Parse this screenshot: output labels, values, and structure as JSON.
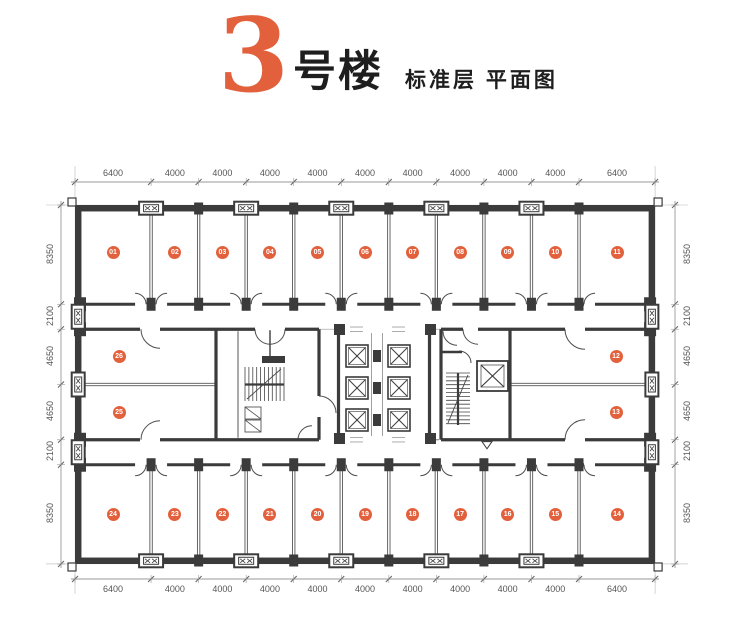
{
  "title": {
    "building_number": "3",
    "building_suffix": "号楼",
    "subtitle": "标准层 平面图"
  },
  "colors": {
    "accent": "#E2603C",
    "wall": "#3B3B3B",
    "dim_text": "#555555"
  },
  "plan": {
    "dimensions_mm": {
      "top": [
        "6400",
        "4000",
        "4000",
        "4000",
        "4000",
        "4000",
        "4000",
        "4000",
        "4000",
        "4000",
        "6400"
      ],
      "bottom": [
        "6400",
        "4000",
        "4000",
        "4000",
        "4000",
        "4000",
        "4000",
        "4000",
        "4000",
        "4000",
        "6400"
      ],
      "left": [
        "8350",
        "2100",
        "4650",
        "4650",
        "2100",
        "8350"
      ],
      "right": [
        "8350",
        "2100",
        "4650",
        "4650",
        "2100",
        "8350"
      ]
    },
    "rooms": {
      "top_row": [
        "01",
        "02",
        "03",
        "04",
        "05",
        "06",
        "07",
        "08",
        "09",
        "10",
        "11"
      ],
      "right_column": [
        "12",
        "13"
      ],
      "bottom_row": [
        "24",
        "23",
        "22",
        "21",
        "20",
        "19",
        "18",
        "17",
        "16",
        "15",
        "14"
      ],
      "left_column": [
        "26",
        "25"
      ]
    },
    "features": [
      "elevator-bank",
      "stairwell-left",
      "stairwell-right",
      "service-elevator",
      "window-vents"
    ]
  }
}
